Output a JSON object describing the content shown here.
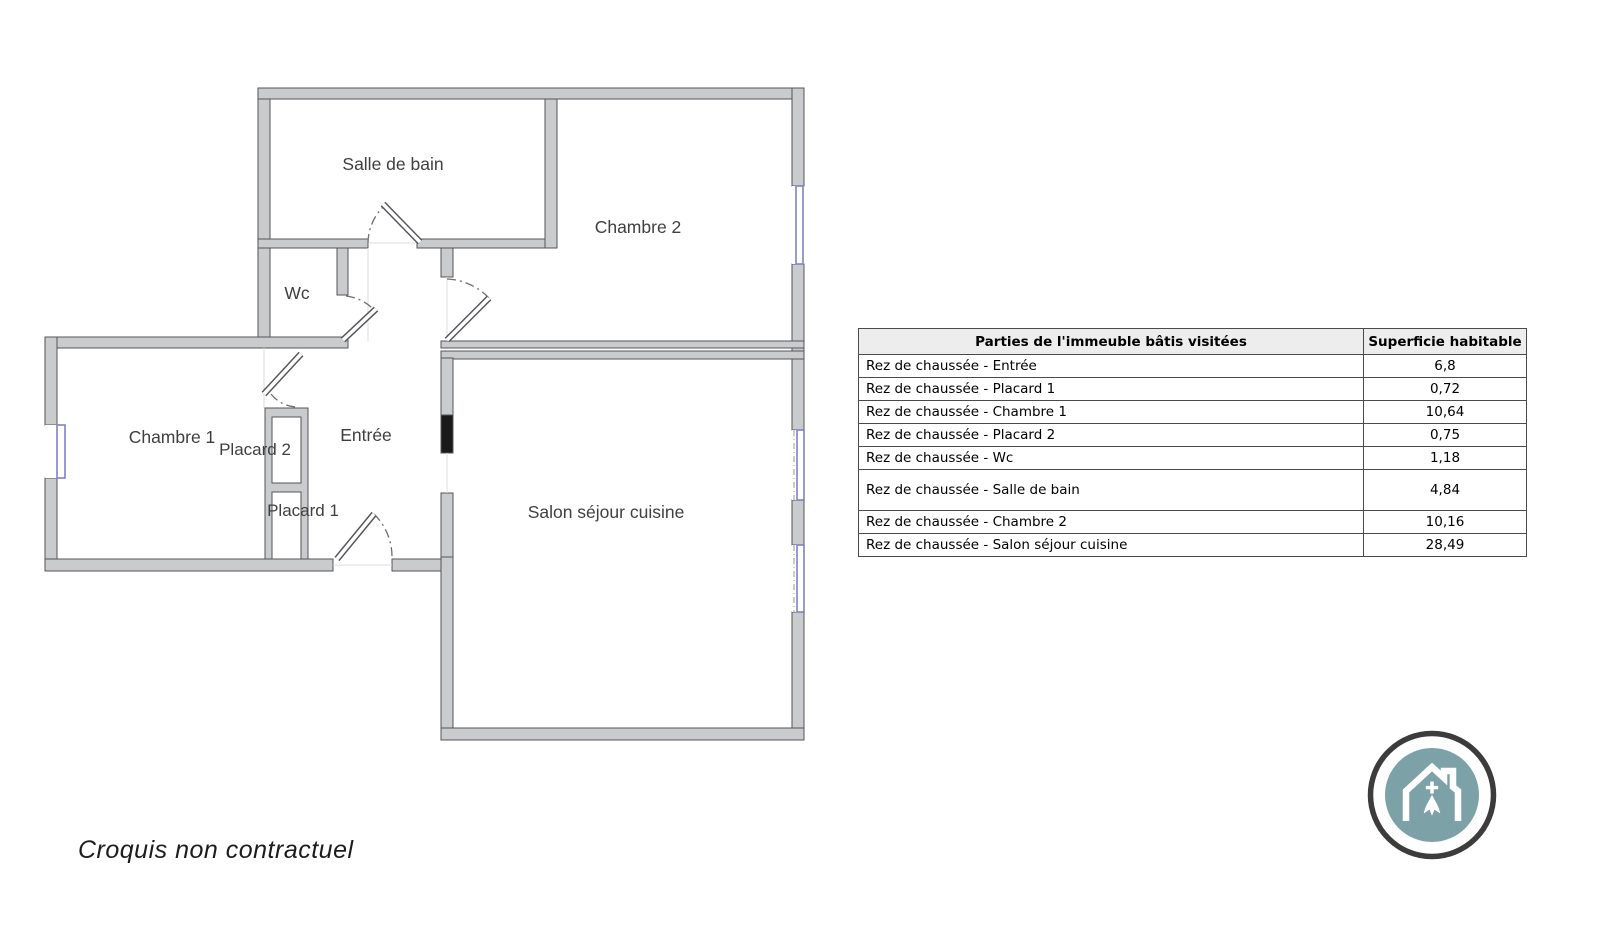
{
  "floor_plan": {
    "rooms": [
      {
        "label": "Salle de bain"
      },
      {
        "label": "Chambre 2"
      },
      {
        "label": "Wc"
      },
      {
        "label": "Chambre 1"
      },
      {
        "label": "Placard 2"
      },
      {
        "label": "Entrée"
      },
      {
        "label": "Placard 1"
      },
      {
        "label": "Salon séjour cuisine"
      }
    ]
  },
  "table": {
    "headers": [
      "Parties de l'immeuble bâtis visitées",
      "Superficie habitable"
    ],
    "rows": [
      {
        "label": "Rez de chaussée - Entrée",
        "value": "6,8"
      },
      {
        "label": "Rez de chaussée - Placard 1",
        "value": "0,72"
      },
      {
        "label": "Rez de chaussée - Chambre 1",
        "value": "10,64"
      },
      {
        "label": "Rez de chaussée - Placard 2",
        "value": "0,75"
      },
      {
        "label": "Rez de chaussée - Wc",
        "value": "1,18"
      },
      {
        "label": "Rez de chaussée - Salle de bain",
        "value": "4,84"
      },
      {
        "label": "Rez de chaussée - Chambre 2",
        "value": "10,16"
      },
      {
        "label": "Rez de chaussée - Salon séjour cuisine",
        "value": "28,49"
      }
    ]
  },
  "footer": {
    "note": "Croquis non contractuel"
  },
  "logo": {
    "symbol": "house-with-ermine-badge"
  },
  "colors": {
    "wall_fill": "#c9cbcd",
    "wall_stroke": "#55565a",
    "window_blue": "#7d84bf",
    "door_black": "#1a1a1a",
    "label": "#3f3f3f",
    "table_border": "#4a4a4c",
    "table_header_bg": "#ededed",
    "logo_teal": "#7ca2a8",
    "logo_ring": "#3c3c3c",
    "text": "#1c1c1c"
  }
}
